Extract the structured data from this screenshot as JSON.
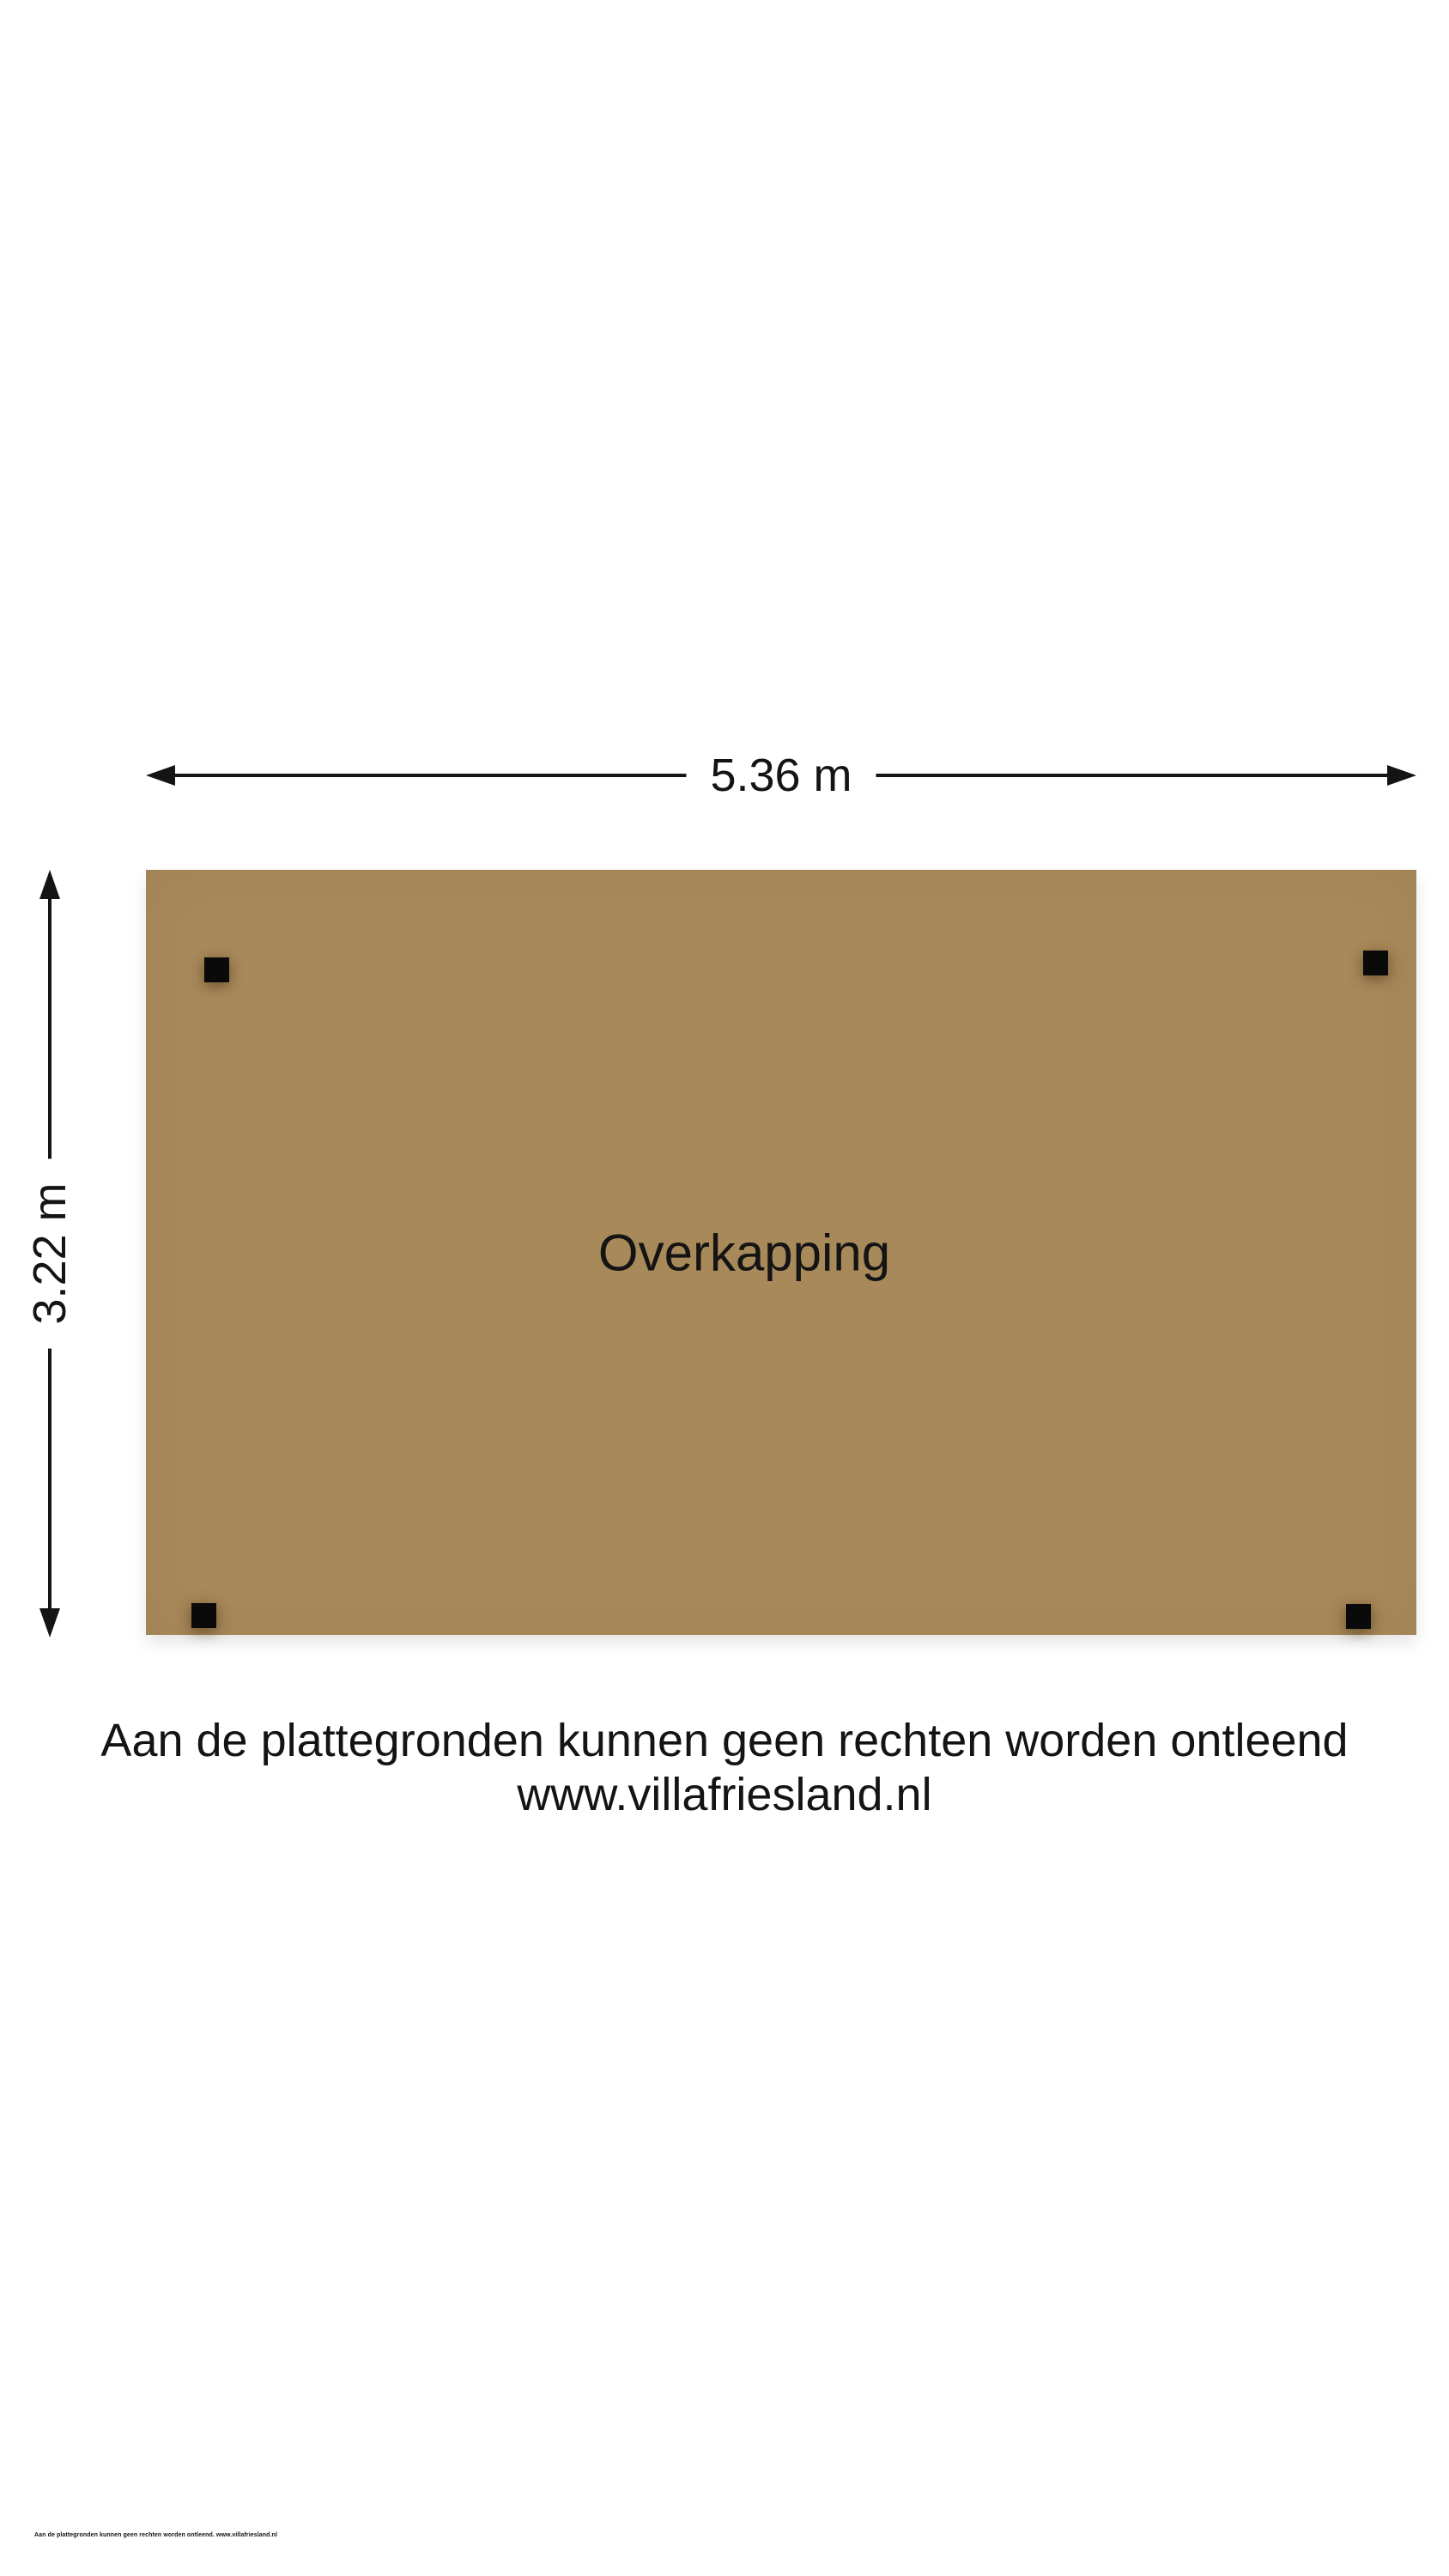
{
  "colors": {
    "page": "#ffffff",
    "ink": "#141414",
    "floor": "#a8895a",
    "post": "#0a0a0a"
  },
  "plan": {
    "room": {
      "label": "Overkapping"
    },
    "dimensions": {
      "width": "5.36 m",
      "height": "3.22 m"
    }
  },
  "disclaimer": {
    "line1": "Aan de plattegronden kunnen geen rechten worden ontleend",
    "line2": "www.villafriesland.nl"
  },
  "footer": {
    "text": "Aan de plattegronden kunnen geen rechten worden ontleend. www.villafriesland.nl"
  }
}
